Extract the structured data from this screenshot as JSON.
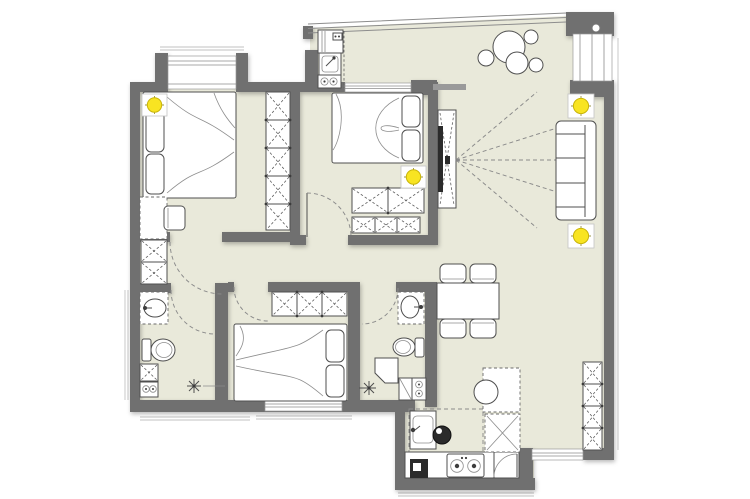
{
  "image_type": "apartment-floor-plan-drawing",
  "palette": {
    "background": "#ffffff",
    "floor": "#e9e9da",
    "wall": "#707070",
    "line": "#4f4f4f",
    "dash": "#8a8a8a",
    "accent": "#f8e422",
    "dark": "#2b2b2b"
  },
  "fixtures_visible": [
    {
      "name": "ceiling-light-symbol",
      "count": 4,
      "color": "#f8e422"
    },
    {
      "name": "double-bed",
      "count": 3
    },
    {
      "name": "wardrobe-x-panel",
      "count": 7
    },
    {
      "name": "three-seat-sofa",
      "count": 1
    },
    {
      "name": "tv-unit-with-viewing-rays",
      "count": 1
    },
    {
      "name": "dining-table-with-4-chairs",
      "count": 1
    },
    {
      "name": "toilet",
      "count": 2
    },
    {
      "name": "wash-basin",
      "count": 4
    },
    {
      "name": "shower-floor-drain",
      "count": 2
    },
    {
      "name": "washing-machine",
      "count": 2
    },
    {
      "name": "stove-2-burner",
      "count": 1
    },
    {
      "name": "kitchen-sink",
      "count": 1
    },
    {
      "name": "potted-plant",
      "count": 1
    },
    {
      "name": "door-swing-arc",
      "count": 6
    },
    {
      "name": "desk-with-chair",
      "count": 1
    },
    {
      "name": "entry-door",
      "count": 1
    },
    {
      "name": "bay-window",
      "count": 1
    }
  ]
}
